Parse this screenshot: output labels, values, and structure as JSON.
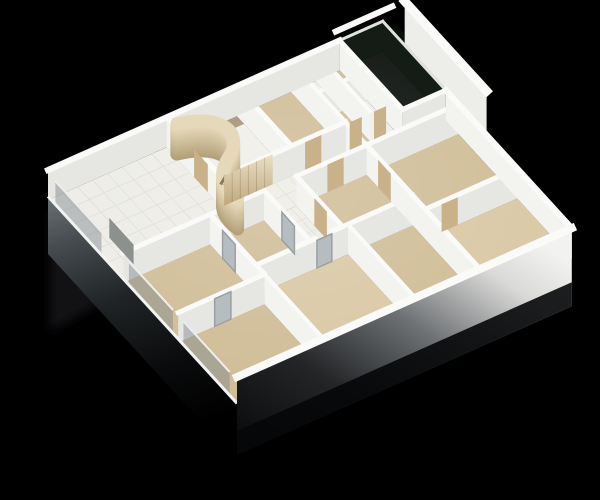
{
  "meta": {
    "description": "3D rendered isometric cutaway floor plan of an apartment on a black background",
    "background": "#000000",
    "canvas": {
      "width": 600,
      "height": 500
    }
  },
  "palette": {
    "wall_top": "#fafaf9",
    "wall_face_s": "#e6e6e2",
    "wall_face_e": "#f3f3f0",
    "floor_tile": "#edece6",
    "tile_line": "#dcdbd3",
    "floor_beige": "#d0bd97",
    "floor_beige_light": "#d9c8a5",
    "floor_white": "#efeee9",
    "balcony_glass": "#0c110d",
    "balcony_strip": "#0a0e0a",
    "glass_face": "#131c15",
    "glass_top": "#dfe3de",
    "counter": "#a39174",
    "door_wood": "#c9b28a",
    "door_glass": "#b6bdc0",
    "door_frame": "#9aa0a3",
    "tv_gray": "#8d918e",
    "glazing_pane": "#7d858b",
    "curve_wood_dark": "#b3a078",
    "curve_wood_light": "#e6d9ba",
    "shelf_shadow": "#8a795b",
    "reflection": "#202325"
  },
  "projection": {
    "origin": [
      48,
      200
    ],
    "u": [
      27,
      -12
    ],
    "v": [
      21,
      23
    ],
    "wall_height": 30,
    "slab_depth": 1.8
  },
  "scene": {
    "floors": [
      {
        "id": "living-room",
        "rect": [
          0,
          0,
          4.4,
          3.6
        ],
        "fill": "floor_tile",
        "tile": 0.55
      },
      {
        "id": "kitchen",
        "rect": [
          4.4,
          0,
          7.0,
          2.6
        ],
        "fill": "floor_white"
      },
      {
        "id": "kitchen-counter",
        "rect": [
          4.5,
          0.12,
          7.0,
          0.62
        ],
        "fill": "counter",
        "lift": 9
      },
      {
        "id": "bedroom-north",
        "rect": [
          7.0,
          0,
          9.0,
          2.6
        ],
        "fill": "floor_beige"
      },
      {
        "id": "closet-1",
        "rect": [
          9.0,
          0,
          9.9,
          1.3
        ],
        "fill": "floor_white"
      },
      {
        "id": "closet-2",
        "rect": [
          9.9,
          0,
          10.8,
          1.3
        ],
        "fill": "floor_beige"
      },
      {
        "id": "closet-3",
        "rect": [
          9.0,
          1.3,
          9.9,
          2.6
        ],
        "fill": "floor_beige"
      },
      {
        "id": "closet-4",
        "rect": [
          9.9,
          1.3,
          10.8,
          2.6
        ],
        "fill": "floor_white"
      },
      {
        "id": "balcony",
        "rect": [
          10.8,
          0,
          12.4,
          3.0
        ],
        "fill": "balcony_glass"
      },
      {
        "id": "balcony-outer-strip",
        "rect": [
          12.4,
          -0.6,
          13.4,
          3.2
        ],
        "fill": "balcony_strip"
      },
      {
        "id": "corridor",
        "rect": [
          4.4,
          2.6,
          9.0,
          3.6
        ],
        "fill": "floor_tile",
        "tile": 0.5
      },
      {
        "id": "corridor-spur",
        "rect": [
          5.2,
          3.6,
          6.4,
          5.8
        ],
        "fill": "floor_tile",
        "tile": 0.5
      },
      {
        "id": "hall-right",
        "rect": [
          9.0,
          2.6,
          10.8,
          3.6
        ],
        "fill": "floor_white"
      },
      {
        "id": "hall-right-2",
        "rect": [
          10.8,
          3.0,
          12.4,
          3.6
        ],
        "fill": "floor_white"
      },
      {
        "id": "bedroom-east",
        "rect": [
          9.0,
          3.6,
          12.4,
          6.4
        ],
        "fill": "floor_beige"
      },
      {
        "id": "room-southeast",
        "rect": [
          9.0,
          6.4,
          12.4,
          9.0
        ],
        "fill": "floor_beige_light"
      },
      {
        "id": "bedroom-west-1",
        "rect": [
          0,
          3.6,
          3.2,
          6.2
        ],
        "fill": "floor_beige"
      },
      {
        "id": "bedroom-west-2",
        "rect": [
          0,
          6.2,
          3.2,
          9.0
        ],
        "fill": "floor_beige"
      },
      {
        "id": "bedroom-mid",
        "rect": [
          3.2,
          3.6,
          5.2,
          5.8
        ],
        "fill": "floor_beige"
      },
      {
        "id": "bedroom-center",
        "rect": [
          6.4,
          3.6,
          9.0,
          5.8
        ],
        "fill": "floor_beige"
      },
      {
        "id": "bedroom-south",
        "rect": [
          3.2,
          5.8,
          6.6,
          9.0
        ],
        "fill": "floor_beige_light"
      },
      {
        "id": "bedroom-south-2",
        "rect": [
          6.6,
          5.8,
          9.0,
          9.0
        ],
        "fill": "floor_beige"
      }
    ],
    "walls": [
      {
        "seg": [
          0,
          0,
          10.8,
          0
        ],
        "t": 6
      },
      {
        "seg": [
          4.4,
          0,
          4.4,
          2.6
        ],
        "t": 5
      },
      {
        "seg": [
          7.0,
          0,
          7.0,
          2.6
        ],
        "t": 5
      },
      {
        "seg": [
          9.0,
          0,
          9.0,
          2.6
        ],
        "t": 4
      },
      {
        "seg": [
          9.9,
          0,
          9.9,
          2.6
        ],
        "t": 4
      },
      {
        "seg": [
          9.0,
          1.3,
          10.8,
          1.3
        ],
        "t": 4
      },
      {
        "seg": [
          10.8,
          0,
          10.8,
          3.0
        ],
        "t": 5
      },
      {
        "seg": [
          10.8,
          3.0,
          12.4,
          3.0
        ],
        "t": 5
      },
      {
        "seg": [
          10.8,
          0,
          12.4,
          0
        ],
        "t": 3,
        "glass": true
      },
      {
        "seg": [
          12.4,
          0,
          12.4,
          3.0
        ],
        "t": 3,
        "glass": true
      },
      {
        "seg": [
          4.4,
          2.6,
          9.0,
          2.6
        ],
        "t": 5
      },
      {
        "seg": [
          9.0,
          2.6,
          9.0,
          3.6
        ],
        "t": 4
      },
      {
        "seg": [
          0,
          3.6,
          5.2,
          3.6
        ],
        "t": 5
      },
      {
        "seg": [
          6.4,
          3.6,
          12.4,
          3.6
        ],
        "t": 5
      },
      {
        "seg": [
          5.2,
          3.6,
          5.2,
          5.8
        ],
        "t": 5
      },
      {
        "seg": [
          6.4,
          3.6,
          6.4,
          5.8
        ],
        "t": 5
      },
      {
        "seg": [
          3.2,
          3.6,
          3.2,
          6.2
        ],
        "t": 5
      },
      {
        "seg": [
          0,
          6.2,
          3.2,
          6.2
        ],
        "t": 5
      },
      {
        "seg": [
          3.2,
          6.2,
          3.2,
          9.0
        ],
        "t": 4
      },
      {
        "seg": [
          3.2,
          5.8,
          5.4,
          5.8
        ],
        "t": 5
      },
      {
        "seg": [
          6.0,
          5.8,
          9.0,
          5.8
        ],
        "t": 5
      },
      {
        "seg": [
          6.6,
          5.8,
          6.6,
          9.0
        ],
        "t": 4
      },
      {
        "seg": [
          9.0,
          3.6,
          9.0,
          9.0
        ],
        "t": 5
      },
      {
        "seg": [
          9.0,
          6.4,
          12.4,
          6.4
        ],
        "t": 5
      },
      {
        "seg": [
          12.4,
          3.0,
          12.4,
          9.0
        ],
        "t": 6
      },
      {
        "seg": [
          11.2,
          -0.7,
          13.3,
          -0.7
        ],
        "t": 6,
        "ztop": 0.6,
        "noface": true
      },
      {
        "seg": [
          13.6,
          -0.5,
          13.6,
          3.4
        ],
        "t": 9,
        "ztop": 0.8,
        "zface": -0.6,
        "faceFill": "#ededea"
      }
    ],
    "doors": [
      {
        "seg": [
          7.5,
          2.6,
          8.1,
          2.6
        ],
        "fill": "door_wood"
      },
      {
        "seg": [
          7.55,
          3.6,
          8.15,
          3.6
        ],
        "fill": "door_wood"
      },
      {
        "seg": [
          4.4,
          1.3,
          4.4,
          1.95
        ],
        "fill": "door_wood"
      },
      {
        "seg": [
          9.0,
          4.15,
          9.0,
          4.75
        ],
        "fill": "door_wood"
      },
      {
        "seg": [
          5.2,
          4.45,
          5.2,
          5.05
        ],
        "fill": "door_glass"
      },
      {
        "seg": [
          6.4,
          4.45,
          6.4,
          5.05
        ],
        "fill": "door_wood"
      },
      {
        "seg": [
          3.2,
          4.2,
          3.2,
          4.8
        ],
        "fill": "door_glass"
      },
      {
        "seg": [
          5.45,
          5.8,
          6.0,
          5.8
        ],
        "fill": "door_glass"
      },
      {
        "seg": [
          1.35,
          6.2,
          1.95,
          6.2
        ],
        "fill": "door_glass"
      },
      {
        "seg": [
          9.6,
          6.4,
          10.2,
          6.4
        ],
        "fill": "door_wood"
      },
      {
        "seg": [
          9.15,
          2.6,
          9.6,
          2.6
        ],
        "fill": "door_wood"
      },
      {
        "seg": [
          10.05,
          2.6,
          10.5,
          2.6
        ],
        "fill": "door_wood"
      }
    ],
    "quads": [
      {
        "id": "wardrobe-wood-wall",
        "seg": [
          4.5,
          2.6,
          6.3,
          2.6
        ],
        "z": [
          0,
          1
        ],
        "fill": "url(#gradWood)",
        "planks": 6
      },
      {
        "id": "tv-panel",
        "seg": [
          0.62,
          2.12,
          0.62,
          3.28
        ],
        "z": [
          0.12,
          0.78
        ],
        "fill": "tv_gray"
      },
      {
        "id": "window-pane-1",
        "seg": [
          0,
          0.35,
          0,
          2.55
        ],
        "z": [
          0,
          0.85
        ],
        "fill": "glazing_pane",
        "opacity": 0.45,
        "top": true
      },
      {
        "id": "window-pane-2",
        "seg": [
          0,
          3.85,
          0,
          5.95
        ],
        "z": [
          0,
          0.85
        ],
        "fill": "glazing_pane",
        "opacity": 0.45,
        "top": true
      },
      {
        "id": "window-pane-3",
        "seg": [
          0,
          6.45,
          0,
          8.65
        ],
        "z": [
          0,
          0.85
        ],
        "fill": "glazing_pane",
        "opacity": 0.45,
        "top": true
      }
    ],
    "curved_wall": {
      "points": [
        [
          4.5,
          0.35
        ],
        [
          5.95,
          0.62
        ],
        [
          6.08,
          1.55
        ],
        [
          5.05,
          2.1
        ],
        [
          4.32,
          2.5
        ],
        [
          4.18,
          2.95
        ],
        [
          4.3,
          3.5
        ]
      ],
      "stroke_px": 13,
      "layers": 14
    },
    "shelf_lines": [
      [
        [
          4.62,
          2.28
        ],
        [
          4.98,
          2.08
        ]
      ],
      [
        [
          4.58,
          2.52
        ],
        [
          4.98,
          2.32
        ]
      ]
    ],
    "exterior": {
      "sw_edge": {
        "from": [
          0,
          0
        ],
        "to": [
          0,
          9
        ]
      },
      "se_edge": {
        "from": [
          0,
          9
        ],
        "to": [
          12.4,
          9
        ]
      }
    },
    "footprint": [
      [
        0,
        0
      ],
      [
        12.4,
        0
      ],
      [
        12.4,
        9
      ],
      [
        0,
        9
      ]
    ]
  }
}
